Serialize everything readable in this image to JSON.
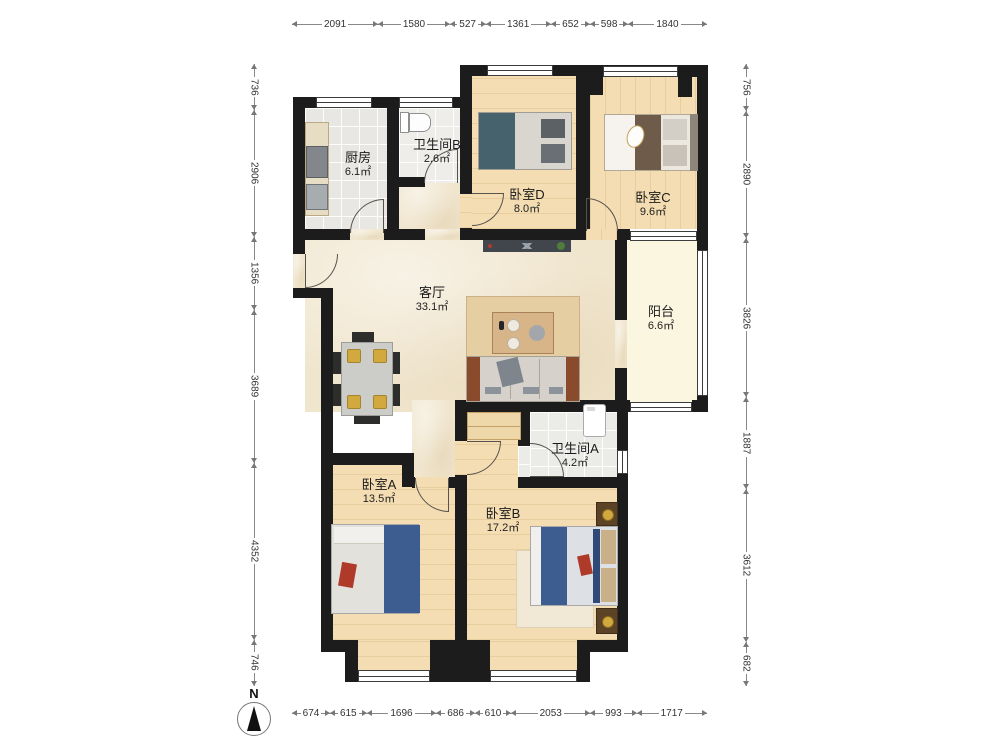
{
  "rooms": {
    "kitchen": {
      "name": "厨房",
      "area": "6.1㎡"
    },
    "bathB": {
      "name": "卫生间B",
      "area": "2.6㎡"
    },
    "bedD": {
      "name": "卧室D",
      "area": "8.0㎡"
    },
    "bedC": {
      "name": "卧室C",
      "area": "9.6㎡"
    },
    "living": {
      "name": "客厅",
      "area": "33.1㎡"
    },
    "balcony": {
      "name": "阳台",
      "area": "6.6㎡"
    },
    "bathA": {
      "name": "卫生间A",
      "area": "4.2㎡"
    },
    "bedA": {
      "name": "卧室A",
      "area": "13.5㎡"
    },
    "bedB": {
      "name": "卧室B",
      "area": "17.2㎡"
    }
  },
  "dimensions": {
    "top": [
      2091,
      1580,
      527,
      1361,
      652,
      598,
      1840
    ],
    "bottom": [
      674,
      615,
      1696,
      686,
      610,
      2053,
      993,
      1717
    ],
    "left": [
      736,
      2906,
      1356,
      3689,
      4352,
      746
    ],
    "right": [
      756,
      2890,
      3826,
      1887,
      3612,
      682
    ]
  },
  "compass": {
    "label": "N"
  },
  "colors": {
    "wall": "#1c1c1c",
    "marble": "#f0e5cd",
    "wood": "#f4ddb2",
    "tile": "#e9e7e3",
    "balcony": "#faf6df",
    "blue": "#3d5c90",
    "teal": "#46626c",
    "red": "#b03a2a",
    "gold": "#d2a93f",
    "sofa": "#d6d2cb",
    "rug": "#e5cfa2",
    "tan": "#d7b588"
  }
}
